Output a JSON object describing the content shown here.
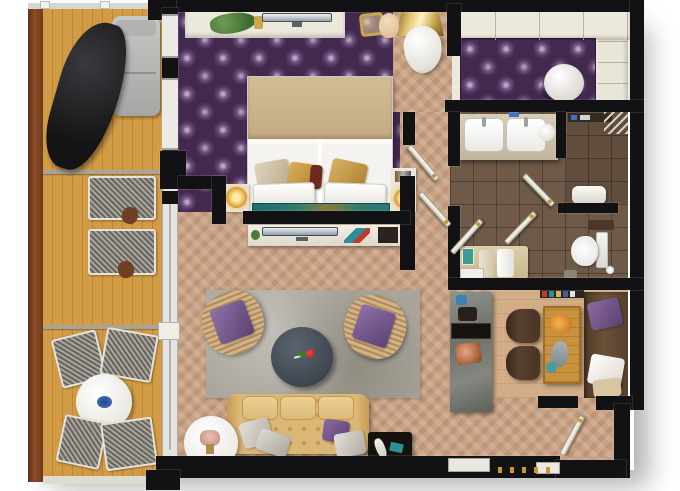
{
  "meta": {
    "kind": "3d-rendered floor plan, top-down view",
    "visible_text": "none",
    "background": "#ffffff"
  },
  "palette": {
    "wall_black": "#121215",
    "deck_wood": "#d29c46",
    "outer_rail_wood": "#7c4224",
    "bedroom_carpet_purple": "#44294f",
    "damask_pattern_light": "#cfbcda",
    "living_floor_tan": "#c9a285",
    "bathroom_tile_brown": "#6f5a49",
    "kitchen_floor": "#d2ad87",
    "rug_gray": "#a9a59b",
    "furniture_cream": "#ece8dc",
    "sofa_tan": "#dcb674",
    "accent_teal": "#2c7a72",
    "accent_gold": "#c9992f",
    "accent_purple": "#6d4f82",
    "coffee_table_slate": "#49525c",
    "dining_wood": "#c8923c"
  },
  "rooms": {
    "terrace": {
      "name": "Terrace with sun loungers, hanging chair, outdoor dining set"
    },
    "bedroom": {
      "name": "Bedroom with double bed, nightstand lamps, TV console, vanity"
    },
    "closet": {
      "name": "Walk-in closet with wardrobes and round ottoman"
    },
    "hallway": {
      "name": "Hallway with white doors"
    },
    "bathroom": {
      "name": "Bathroom with double sinks, shower, WC, towel bench"
    },
    "living": {
      "name": "Living room with tufted sofa, rattan armchairs, round coffee table with rose"
    },
    "kitchen": {
      "name": "Kitchen and dining with counter, wooden table, corner bench"
    },
    "entry": {
      "name": "Entry hall with door"
    }
  },
  "furniture": {
    "terrace": [
      "sun-lounger",
      "hanging-chair",
      "woven-lounger",
      "woven-lounger",
      "side-table",
      "side-table",
      "round-table",
      "woven-chair",
      "woven-chair",
      "woven-chair",
      "woven-chair",
      "blue-plate"
    ],
    "bedroom": [
      "console-with-plant",
      "flat-tv",
      "gold-mirror-console",
      "gold-chair",
      "cream-chair",
      "white-lounge-chair",
      "double-bed",
      "gold-pillows",
      "white-pillows",
      "teal-runner",
      "nightstand",
      "nightstand",
      "glowing-lamp",
      "glowing-lamp"
    ],
    "closet": [
      "wardrobe-top",
      "wardrobe-right",
      "round-ottoman"
    ],
    "bathroom": [
      "double-sink-vanity",
      "faucets",
      "vessel-bowl",
      "shower-shelf",
      "glass-corner",
      "shower-bench",
      "toilet",
      "toilet-paper",
      "towel-bench",
      "towels",
      "teal-art"
    ],
    "living": [
      "area-rug",
      "rattan-armchair",
      "rattan-armchair",
      "coffee-table",
      "rose",
      "tufted-sofa",
      "silver-pillows",
      "purple-pillow",
      "teal-console",
      "white-side-table",
      "lamp",
      "dark-side-table",
      "tv-sideboard",
      "magazines"
    ],
    "kitchen": [
      "marble-counter",
      "black-shelf",
      "copper-pot",
      "bottles",
      "dining-table",
      "food-plates",
      "dining-chair",
      "dining-chair",
      "corner-bench",
      "purple-pillow",
      "white-pillow",
      "book-shelf-strip"
    ],
    "entry": [
      "entry-door",
      "threshold"
    ]
  }
}
